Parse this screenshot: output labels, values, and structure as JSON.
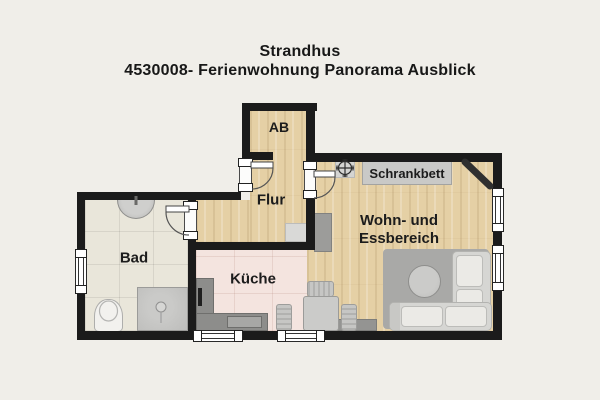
{
  "title": {
    "line1": "Strandhus",
    "line2": "4530008- Ferienwohnung Panorama Ausblick"
  },
  "rooms": {
    "ab": "AB",
    "flur": "Flur",
    "bad": "Bad",
    "kueche": "Küche",
    "wohn_line1": "Wohn- und",
    "wohn_line2": "Essbereich",
    "schrankbett": "Schrankbett"
  },
  "icons": {
    "ceiling_light": "ceiling-light-icon",
    "corner_tv": "corner-tv-icon"
  },
  "colors": {
    "background": "#f0eee9",
    "wall": "#1b1b1b",
    "wood_floor": "#e5d0a5",
    "bath_floor": "#e9e6da",
    "kitchen_floor": "#f4e4df",
    "furniture_gray": "#c9c9c7",
    "counter_gray": "#8d8d8b",
    "rug_gray": "#a9a9a7",
    "text": "#1c1c1c"
  }
}
